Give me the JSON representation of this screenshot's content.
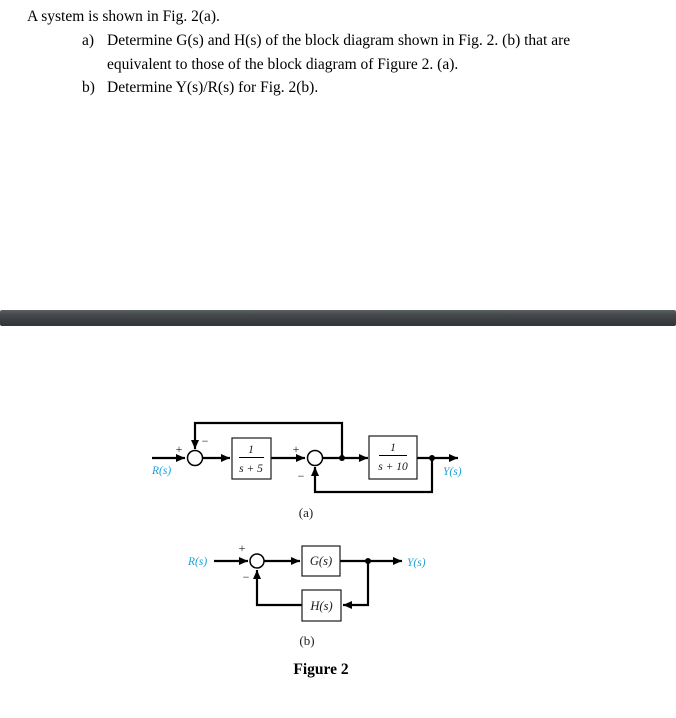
{
  "problem": {
    "intro": "A system is shown in Fig. 2(a).",
    "item_a": {
      "marker": "a)",
      "line1": "Determine G(s) and H(s) of the block diagram shown in Fig. 2. (b) that are",
      "line2": "equivalent to those of the block diagram of Figure 2. (a)."
    },
    "item_b": {
      "marker": "b)",
      "text": "Determine Y(s)/R(s) for Fig. 2(b)."
    }
  },
  "diagram_a": {
    "caption": "(a)",
    "input_label": "R(s)",
    "output_label": "Y(s)",
    "sum1": {
      "plus": "+",
      "minus": "−"
    },
    "sum2": {
      "plus": "+",
      "minus": "−"
    },
    "block1": {
      "numerator": "1",
      "denominator": "s + 5"
    },
    "block2": {
      "numerator": "1",
      "denominator": "s + 10"
    }
  },
  "diagram_b": {
    "caption": "(b)",
    "input_label": "R(s)",
    "output_label": "Y(s)",
    "sum": {
      "plus": "+",
      "minus": "−"
    },
    "forward_block": "G(s)",
    "feedback_block": "H(s)"
  },
  "figure_caption": "Figure 2",
  "colors": {
    "signal_label": "#1b9fd8",
    "diagram_line": "#000000",
    "divider": "#3a3e41"
  }
}
